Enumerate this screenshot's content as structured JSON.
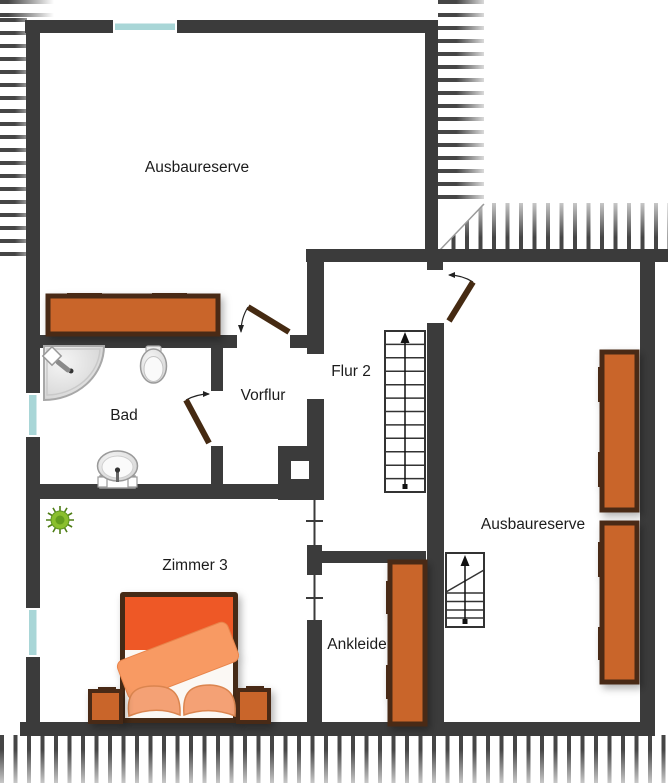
{
  "floorplan": {
    "type": "residential-floor-plan",
    "rooms": [
      {
        "name": "ausbaureserve-top",
        "label": "Ausbaureserve"
      },
      {
        "name": "bad",
        "label": "Bad"
      },
      {
        "name": "vorflur",
        "label": "Vorflur"
      },
      {
        "name": "flur-2",
        "label": "Flur 2"
      },
      {
        "name": "ausbaureserve-right",
        "label": "Ausbaureserve"
      },
      {
        "name": "zimmer-3",
        "label": "Zimmer 3"
      },
      {
        "name": "ankleide",
        "label": "Ankleide"
      }
    ],
    "colors": {
      "wall": "#3b3b3b",
      "window_pane": "#a9d6d7",
      "furniture_fill": "#c96529",
      "furniture_border": "#4a2c12",
      "door_leaf": "#452a12",
      "bed_mattress": "#ee5927",
      "bed_blanket": "#f89a64",
      "bed_pillow": "#f4a174",
      "bed_sheet": "#fbf8f4",
      "plant": "#8abf2e",
      "label_text": "#1c1c1c"
    },
    "symbols": [
      "roof-overhang-hatch",
      "window",
      "door-swing",
      "staircase-up",
      "staircase-small",
      "chimney",
      "sideboard",
      "wardrobe",
      "double-bed",
      "nightstand",
      "corner-shower",
      "toilet",
      "washbasin",
      "plant"
    ]
  }
}
